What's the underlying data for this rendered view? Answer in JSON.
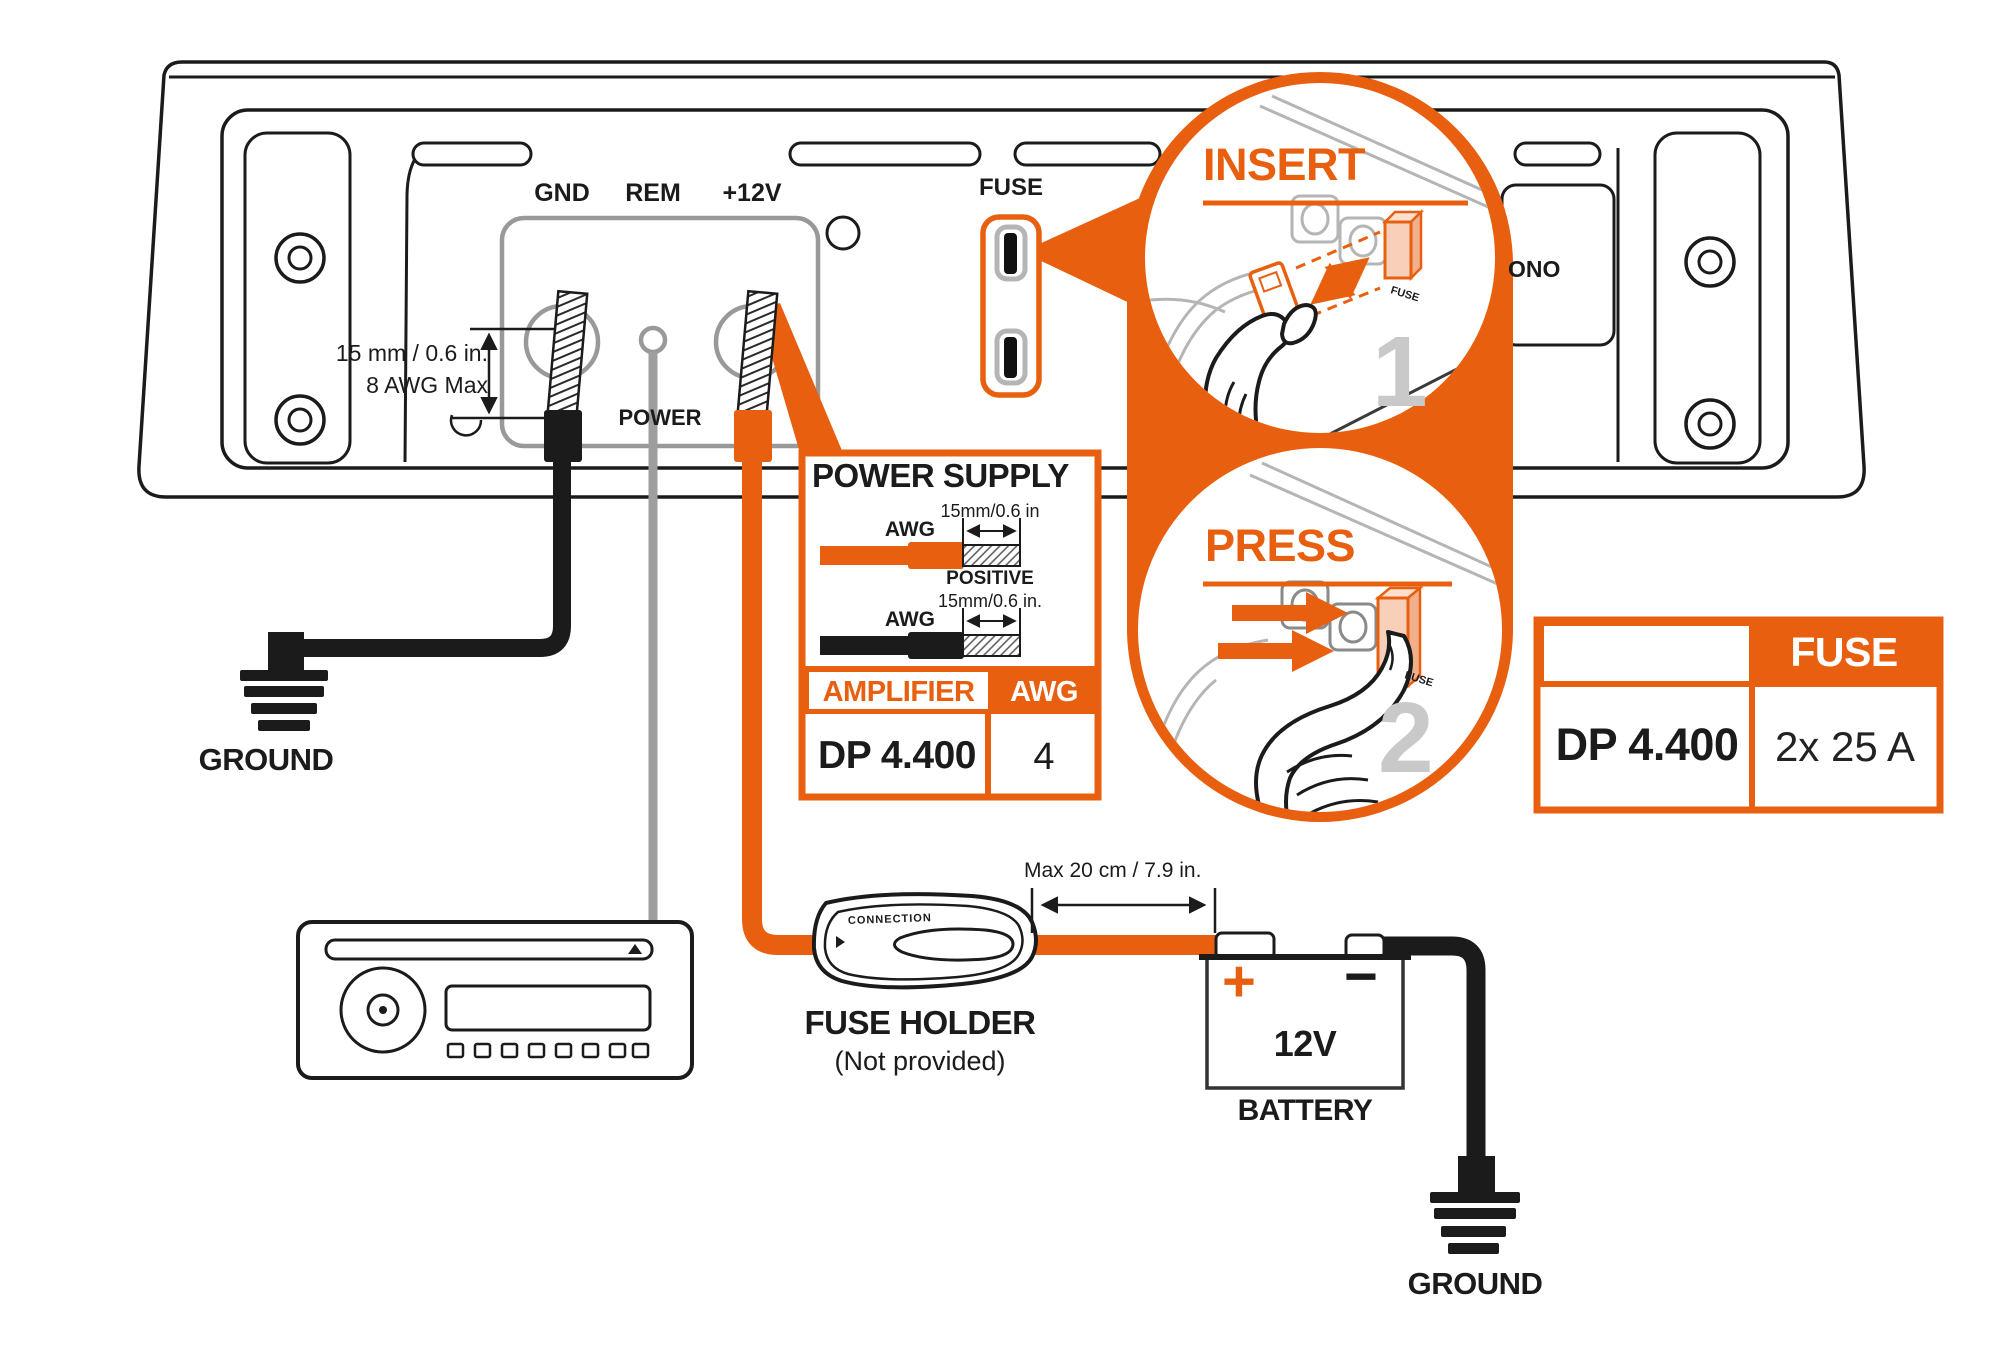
{
  "colors": {
    "accent": "#E8600F",
    "fuse_highlight": "#F8CFB8",
    "step_number_gray": "#C9C9C9"
  },
  "amplifier": {
    "terminals": {
      "gnd": "GND",
      "rem": "REM",
      "plus12v": "+12V"
    },
    "power_label": "POWER",
    "fuse_label": "FUSE",
    "mono_partial": "ONO"
  },
  "wire_note": {
    "line1": "15 mm / 0.6 in.",
    "line2": "8 AWG Max"
  },
  "ground_left": {
    "label": "GROUND"
  },
  "power_supply": {
    "title": "POWER SUPPLY",
    "positive": {
      "awg": "AWG",
      "dim": "15mm/0.6 in",
      "label": "POSITIVE"
    },
    "negative": {
      "awg": "AWG",
      "dim": "15mm/0.6 in."
    },
    "table": {
      "col1": "AMPLIFIER",
      "col2": "AWG",
      "model": "DP 4.400",
      "awg_value": "4"
    }
  },
  "steps": {
    "insert": {
      "title": "INSERT",
      "number": "1",
      "fuse_label": "FUSE"
    },
    "press": {
      "title": "PRESS",
      "number": "2",
      "fuse_label": "FUSE"
    }
  },
  "fuse_table": {
    "header": "FUSE",
    "model": "DP 4.400",
    "value": "2x 25 A"
  },
  "fuse_holder": {
    "title": "FUSE HOLDER",
    "subtitle": "(Not provided)",
    "brand": "CONNECTION"
  },
  "dimension": {
    "label": "Max 20 cm / 7.9 in."
  },
  "battery": {
    "plus": "+",
    "minus": "−",
    "voltage": "12V",
    "label": "BATTERY"
  },
  "ground_right": {
    "label": "GROUND"
  }
}
